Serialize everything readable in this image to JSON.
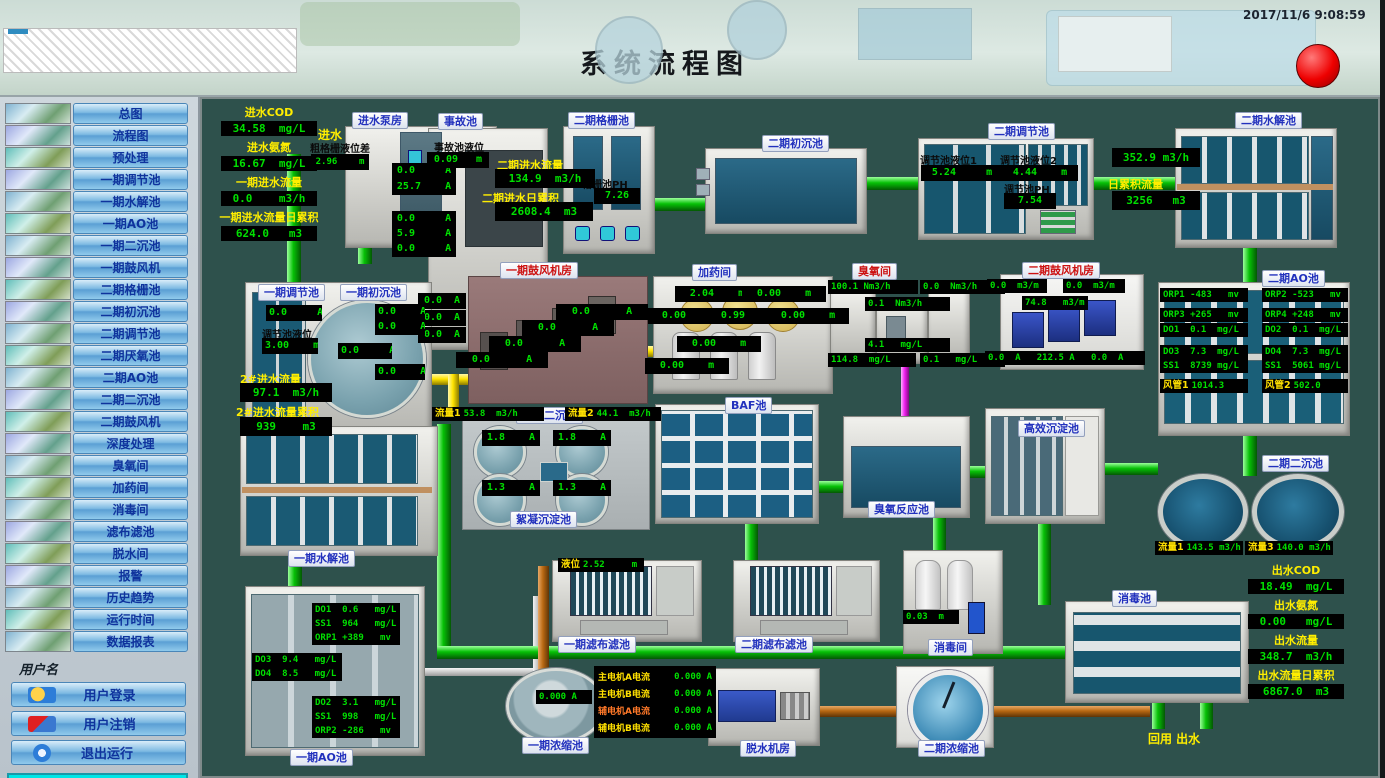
{
  "header": {
    "title": "系统流程图",
    "timestamp": "2017/11/6 9:08:59"
  },
  "sidebar": {
    "items": [
      "总图",
      "流程图",
      "预处理",
      "一期调节池",
      "一期水解池",
      "一期AO池",
      "一期二沉池",
      "一期鼓风机",
      "二期格栅池",
      "二期初沉池",
      "二期调节池",
      "二期厌氧池",
      "二期AO池",
      "二期二沉池",
      "二期鼓风机",
      "深度处理",
      "臭氧间",
      "加药间",
      "消毒间",
      "滤布滤池",
      "脱水间",
      "报警",
      "历史趋势",
      "运行时间",
      "数据报表"
    ],
    "username_label": "用户名",
    "user_buttons": [
      "用户登录",
      "用户注销",
      "退出运行"
    ],
    "company": "山东新日电气设备有限公司"
  },
  "colors": {
    "accent_green": "#00e000",
    "label_yellow": "#ffee00",
    "pipe_green": "#06c006",
    "pipe_yellow": "#ffe400",
    "pipe_orange": "#b86812",
    "pipe_magenta": "#f020f0",
    "alarm_red": "#ee0000"
  },
  "plant": {
    "inlet_stats": [
      {
        "label": "进水COD",
        "value": "34.58  mg/L"
      },
      {
        "label": "进水氨氮",
        "value": "16.67  mg/L"
      },
      {
        "label": "一期进水流量",
        "value": "0.0    m3/h"
      },
      {
        "label": "一期进水流量日累积",
        "value": "624.0   m3"
      }
    ],
    "inlet_text": "进水",
    "pump_house": {
      "label": "进水泵房",
      "level_label": "粗格栅液位差",
      "level": "2.96    m",
      "cur1": "0.0     A",
      "cur2": "25.7    A",
      "cur3": "0.0     A",
      "cur4": "5.9     A",
      "cur5": "0.0     A"
    },
    "accident": {
      "label": "事故池",
      "level_label": "事故池液位",
      "level": "0.09   m",
      "cur1": "0.0  A",
      "cur2": "0.0  A",
      "cur3": "0.0  A"
    },
    "p2_inflow": {
      "flow_label": "二期进水流量",
      "flow": "134.9  m3/h",
      "total_label": "二期进水日累积",
      "total": "2608.4  m3"
    },
    "grid": {
      "label": "二期格栅池",
      "ph_label": "格栅池PH",
      "ph": "7.26"
    },
    "p2_primary": {
      "label": "二期初沉池"
    },
    "p2_reg": {
      "label": "二期调节池",
      "lv1_label": "调节池液位1",
      "lv1": "5.24     m",
      "lv2_label": "调节池液位2",
      "lv2": "4.44    m",
      "ph_label": "调节池PH",
      "ph": "7.54"
    },
    "p2_hyd": {
      "label": "二期水解池",
      "flow": "352.9 m3/h",
      "total_label": "日累积流量",
      "total": "3256   m3"
    },
    "p1_reg": {
      "label": "一期调节池",
      "label2": "一期初沉池",
      "cur1": "0.0     A",
      "level_label": "调节池液位",
      "level": "3.00    m",
      "cur2": "0.0    A",
      "cur3": "0.0    A",
      "cur4": "0.0     A",
      "cur5": "0.0    A",
      "flow_label": "2#进水流量",
      "flow": "97.1  m3/h",
      "total_label": "2#进水流量累积",
      "total": "939    m3"
    },
    "p1_blower": {
      "label": "一期鼓风机房",
      "cur1": "0.0      A",
      "cur2": "0.0      A",
      "cur3": "0.0      A",
      "cur4": "0.0      A"
    },
    "dosing": {
      "label": "加药间",
      "lv1": "2.04    m",
      "lv2": "0.00    m",
      "lv3": "0.00    m",
      "lv4": "0.99    m",
      "lv5": "0.00    m",
      "lv6": "0.00    m",
      "lv7": "0.00    m"
    },
    "ozone": {
      "label": "臭氧间",
      "v1": "100.1 Nm3/h",
      "v2": "0.0  Nm3/h",
      "v3": "0.1  Nm3/h",
      "v4": "4.1   mg/L",
      "v5": "114.8  mg/L",
      "v6": "0.1   mg/L"
    },
    "p2_blower": {
      "label": "二期鼓风机房",
      "v1": "0.0  m3/m",
      "v2": "0.0  m3/m",
      "v3": "74.8   m3/m",
      "bottom": "0.0  A   212.5 A   0.0  A"
    },
    "p2_ao": {
      "label": "二期AO池",
      "l1": "ORP1 -483   mv",
      "l2": "ORP3 +265   mv",
      "l3": "DO1  0.1  mg/L",
      "l4": "DO3  7.3  mg/L",
      "l5": "SS1  8739 mg/L",
      "r1": "ORP2 -523   mv",
      "r2": "ORP4 +248   mv",
      "r3": "DO2  0.1  mg/L",
      "r4": "DO4  7.3  mg/L",
      "r5": "SS1  5061 mg/L",
      "duct1_label": "风管1",
      "duct1": "1014.3",
      "duct2_label": "风管2",
      "duct2": "502.0"
    },
    "p1_sec": {
      "label": "一期二沉池",
      "sub_label": "絮凝沉淀池",
      "flow1_label": "流量1",
      "flow1": "53.8  m3/h",
      "flow2_label": "流量2",
      "flow2": "44.1  m3/h",
      "cur1": "1.8    A",
      "cur2": "1.8    A",
      "cur3": "1.3    A",
      "cur4": "1.3    A"
    },
    "baf": {
      "label": "BAF池"
    },
    "ozone_reaction": {
      "label": "臭氧反应池"
    },
    "high_eff": {
      "label": "高效沉淀池"
    },
    "p2_sec": {
      "label": "二期二沉池",
      "flow1_label": "流量1",
      "flow1": "143.5 m3/h",
      "flow3_label": "流量3",
      "flow3": "140.0 m3/h"
    },
    "p1_hyd": {
      "label": "一期水解池"
    },
    "p1_ao": {
      "label": "一期AO池",
      "b1r1": "DO1  0.6   mg/L",
      "b1r2": "SS1  964   mg/L",
      "b1r3": "ORP1 +389   mv",
      "b2r1": "DO3  9.4   mg/L",
      "b2r2": "DO4  8.5   mg/L",
      "b3r1": "DO2  3.1   mg/L",
      "b3r2": "SS1  998   mg/L",
      "b3r3": "ORP2 -286   mv"
    },
    "filter1": {
      "label": "一期滤布滤池",
      "level_label": "液位",
      "level": "2.52     m"
    },
    "filter2": {
      "label": "二期滤布滤池"
    },
    "disinfect_room": {
      "label": "消毒间",
      "level": "0.03  m"
    },
    "disinfect_tank": {
      "label": "消毒池"
    },
    "p1_thickener": {
      "label": "一期浓缩池",
      "current": "0.000 A"
    },
    "dewater": {
      "label": "脱水机房",
      "motors": [
        {
          "label": "主电机A电流",
          "value": "0.000 A"
        },
        {
          "label": "主电机B电流",
          "value": "0.000 A"
        },
        {
          "label": "辅电机A电流",
          "value": "0.000 A"
        },
        {
          "label": "辅电机B电流",
          "value": "0.000 A"
        }
      ]
    },
    "p2_thickener": {
      "label": "二期浓缩池"
    },
    "outlet_stats": [
      {
        "label": "出水COD",
        "value": "18.49  mg/L"
      },
      {
        "label": "出水氨氮",
        "value": "0.00   mg/L"
      },
      {
        "label": "出水流量",
        "value": "348.7  m3/h"
      },
      {
        "label": "出水流量日累积",
        "value": "6867.0  m3"
      }
    ],
    "reuse_outlet": "回用  出水"
  }
}
